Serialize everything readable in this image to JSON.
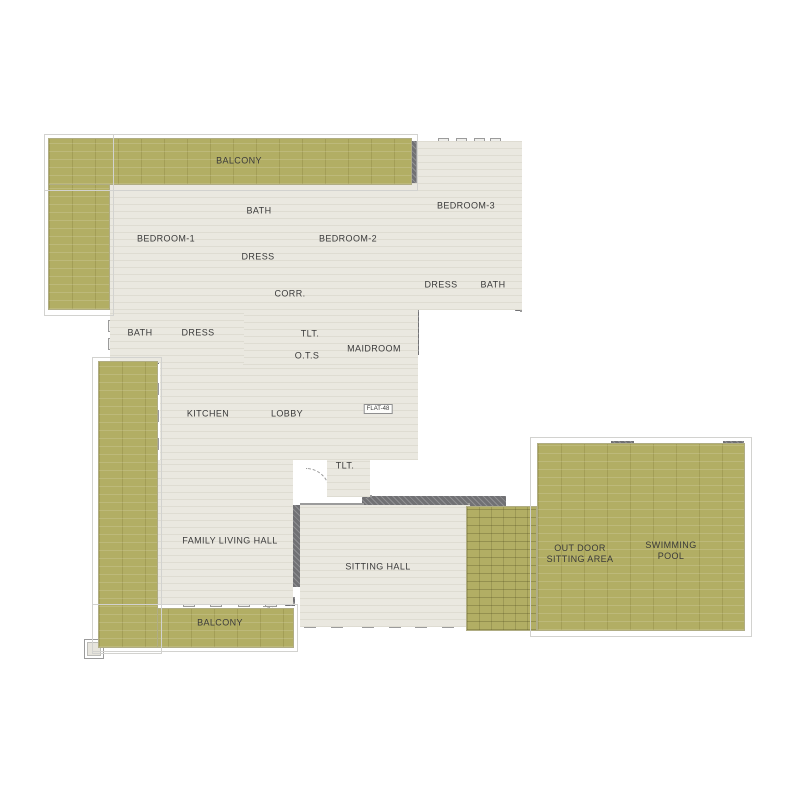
{
  "plan": {
    "type": "residential floor plan",
    "flat_tag": "FLAT-48"
  },
  "colors": {
    "balcony_olive": "#b2ae64",
    "floor": "#eae8e0",
    "wall": "#9b9b9b",
    "wall_dark": "#717174",
    "pool_teal": "#45c8c2"
  },
  "rooms": [
    {
      "label": "BALCONY"
    },
    {
      "label": "BEDROOM-1"
    },
    {
      "label": "BATH"
    },
    {
      "label": "DRESS"
    },
    {
      "label": "BEDROOM-2"
    },
    {
      "label": "BEDROOM-3"
    },
    {
      "label": "CORR."
    },
    {
      "label": "DRESS"
    },
    {
      "label": "BATH"
    },
    {
      "label": "BATH"
    },
    {
      "label": "DRESS"
    },
    {
      "label": "TLT."
    },
    {
      "label": "O.T.S"
    },
    {
      "label": "MAIDROOM"
    },
    {
      "label": "KITCHEN"
    },
    {
      "label": "LOBBY"
    },
    {
      "label": "FLAT-48"
    },
    {
      "label": "TLT."
    },
    {
      "label": "FAMILY LIVING HALL"
    },
    {
      "label": "SITTING HALL"
    },
    {
      "label": "BALCONY"
    },
    {
      "label": "OUT DOOR\nSITTING AREA"
    },
    {
      "label": "SWIMMING\nPOOL"
    }
  ]
}
